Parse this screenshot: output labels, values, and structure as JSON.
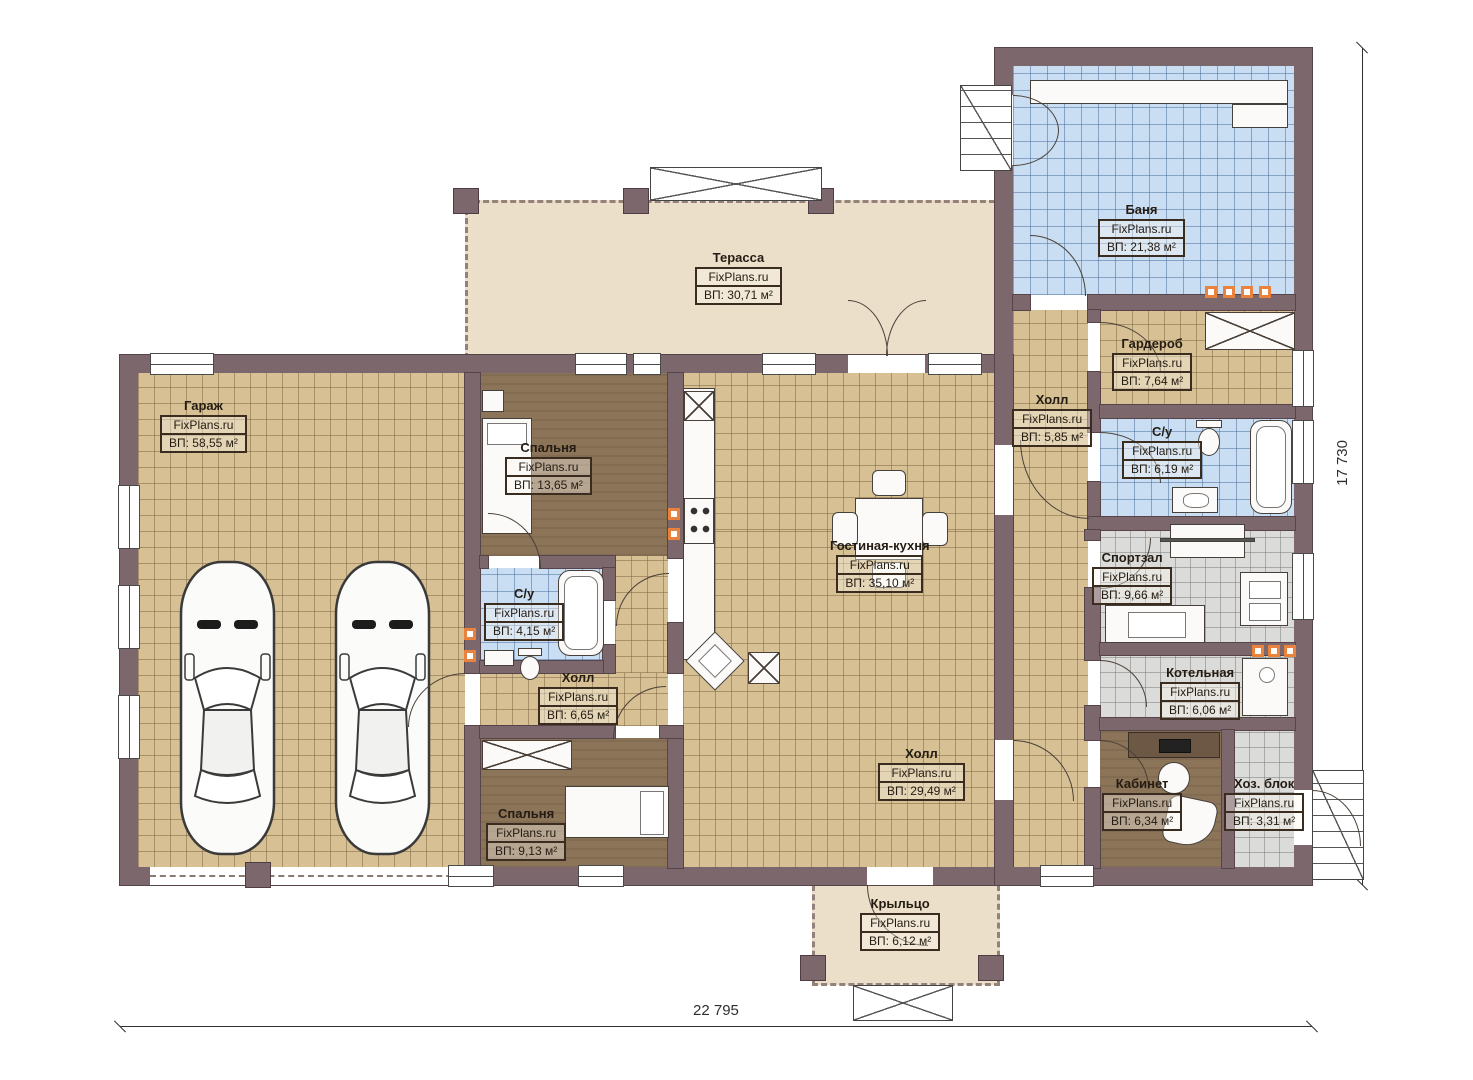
{
  "brand": "FixPlans.ru",
  "dimensions": {
    "width": "22 795",
    "height": "17 730"
  },
  "rooms": {
    "garage": {
      "name": "Гараж",
      "area": "ВП: 58,55 м²"
    },
    "bedroom_top": {
      "name": "Спальня",
      "area": "ВП: 13,65 м²"
    },
    "bathroom_small": {
      "name": "С/у",
      "area": "ВП: 4,15 м²"
    },
    "hall_small": {
      "name": "Холл",
      "area": "ВП: 6,65 м²"
    },
    "bedroom_bottom": {
      "name": "Спальня",
      "area": "ВП: 9,13 м²"
    },
    "living_kitchen": {
      "name": "Гостиная-кухня",
      "area": "ВП: 35,10 м²"
    },
    "hall_main": {
      "name": "Холл",
      "area": "ВП: 29,49 м²"
    },
    "hall_right": {
      "name": "Холл",
      "area": "ВП: 5,85 м²"
    },
    "wardrobe": {
      "name": "Гардероб",
      "area": "ВП: 7,64 м²"
    },
    "bathroom_right": {
      "name": "С/у",
      "area": "ВП: 6,19 м²"
    },
    "banya": {
      "name": "Баня",
      "area": "ВП: 21,38 м²"
    },
    "gym": {
      "name": "Спортзал",
      "area": "ВП: 9,66 м²"
    },
    "boiler": {
      "name": "Котельная",
      "area": "ВП: 6,06 м²"
    },
    "office": {
      "name": "Кабинет",
      "area": "ВП: 6,34 м²"
    },
    "utility": {
      "name": "Хоз. блок",
      "area": "ВП: 3,31 м²"
    },
    "terrace": {
      "name": "Терасса",
      "area": "ВП: 30,71 м²"
    },
    "porch": {
      "name": "Крыльцо",
      "area": "ВП: 6,12 м²"
    }
  },
  "colors": {
    "wall": "#7c676c",
    "tile_tan": "#d6c094",
    "tile_blue": "#cadef3",
    "tile_gray": "#dbdbd9",
    "floor_brown": "#8c7459",
    "terrace_beige": "#ecdfc9",
    "accent_orange": "#e8823c"
  }
}
